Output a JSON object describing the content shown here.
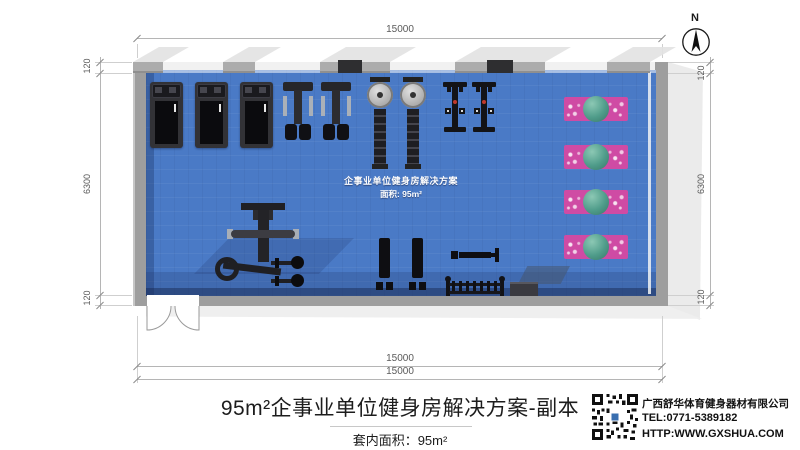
{
  "colors": {
    "floor": "#4a7ac6",
    "floor_shadow": "#2e4f8c",
    "wall": "#9e9e9e",
    "wall_light": "#ebebeb",
    "mat_pink": "#cf4ba4",
    "ball_teal": "#4f9c8a",
    "equipment_dark": "#1b1b1d",
    "dim_line": "#b5b5b5",
    "dim_text": "#5a5a5a",
    "ink": "#1c1c1c",
    "accent_red": "#c0392b"
  },
  "north": {
    "label": "N"
  },
  "dimensions": {
    "top": "15000",
    "bottom": [
      "15000",
      "15000"
    ],
    "left": [
      "120",
      "6300",
      "120"
    ],
    "right": [
      "120",
      "6300",
      "120"
    ]
  },
  "floor_label": {
    "line1": "企事业单位健身房解决方案",
    "line2": "面积: 95m²"
  },
  "title_block": {
    "title": "95m²企事业单位健身房解决方案-副本",
    "area_label": "套内面积：95m²"
  },
  "company": {
    "name": "广西舒华体育健身器材有限公司",
    "tel": "TEL:0771-5389182",
    "url": "HTTP:WWW.GXSHUA.COM"
  },
  "equipment": [
    {
      "name": "treadmill",
      "count": 3
    },
    {
      "name": "strength-machine",
      "count": 2
    },
    {
      "name": "rowing-machine",
      "count": 2
    },
    {
      "name": "spin-bike",
      "count": 2
    },
    {
      "name": "yoga-mat-with-ball",
      "count": 4
    },
    {
      "name": "multi-station-trainer",
      "count": 1
    },
    {
      "name": "flat-bench",
      "count": 2
    },
    {
      "name": "adjustable-bench",
      "count": 1
    },
    {
      "name": "dumbbell-rack",
      "count": 1
    },
    {
      "name": "step-platform",
      "count": 1
    }
  ]
}
